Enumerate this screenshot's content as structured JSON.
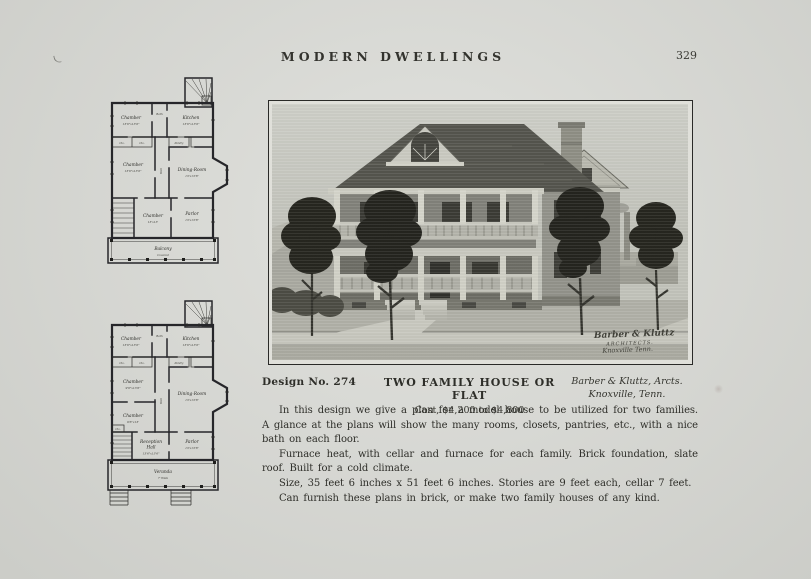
{
  "page": {
    "header_title": "MODERN DWELLINGS",
    "page_number": "329"
  },
  "caption": {
    "design_no": "Design No. 274",
    "title": "TWO FAMILY HOUSE OR FLAT",
    "cost": "Cost, $4,200 to $4,800",
    "architect_line1": "Barber & Kluttz, Arcts.",
    "architect_line2": "Knoxville, Tenn."
  },
  "body": {
    "para1": "In this design we give a plan for a model house to be utilized for two families.  A glance at the plans will show the many rooms, closets, pantries, etc., with a nice bath on each floor.",
    "para2": "Furnace heat, with cellar and furnace for each family.  Brick foundation, slate roof.  Built for a cold climate.",
    "para3": "Size, 35 feet 6 inches x 51 feet 6 inches.  Stories are 9 feet each, cellar 7 feet.",
    "para4": "Can furnish these plans in brick, or make two family houses of any kind."
  },
  "photo": {
    "signature_line1": "Barber & Kluttz",
    "signature_line2": "ARCHITECTS.",
    "signature_line3": "Knoxville Tenn."
  },
  "plans": {
    "second_floor": {
      "chamber1": "Chamber",
      "chamber1_d": "13'6\"x13'6\"",
      "bath": "Bath",
      "kitchen": "Kitchen",
      "kitchen_d": "13'6\"x13'6\"",
      "chamber2": "Chamber",
      "chamber2_d": "13'6\"x13'6\"",
      "hall": "Hall",
      "dining": "Dining-Room",
      "dining_d": "13'x13'6\"",
      "chamber3": "Chamber",
      "chamber3_d": "13'x13'",
      "parlor": "Parlor",
      "parlor_d": "13'x13'6\"",
      "clo": "Clo.",
      "pantry": "Pantry",
      "balcony": "Balcony",
      "balcony_sub": "Covered"
    },
    "first_floor": {
      "chamber1": "Chamber",
      "chamber1_d": "13'6\"x13'6\"",
      "bath": "Bath",
      "kitchen": "Kitchen",
      "kitchen_d": "13'6\"x13'6\"",
      "chamber2": "Chamber",
      "chamber2_d": "9'6\"x13'6\"",
      "hall": "Hall",
      "dining": "Dining-Room",
      "dining_d": "13'x13'6\"",
      "chamber3": "Chamber",
      "chamber3_d": "9'6\"x13'",
      "reception1": "Reception",
      "reception2": "Hall",
      "reception_d": "13'6\"x13'6\"",
      "parlor": "Parlor",
      "parlor_d": "13'x13'6\"",
      "clo": "Clo.",
      "pantry": "Pantry",
      "veranda": "Veranda",
      "veranda_sub": "7' Wide"
    }
  }
}
